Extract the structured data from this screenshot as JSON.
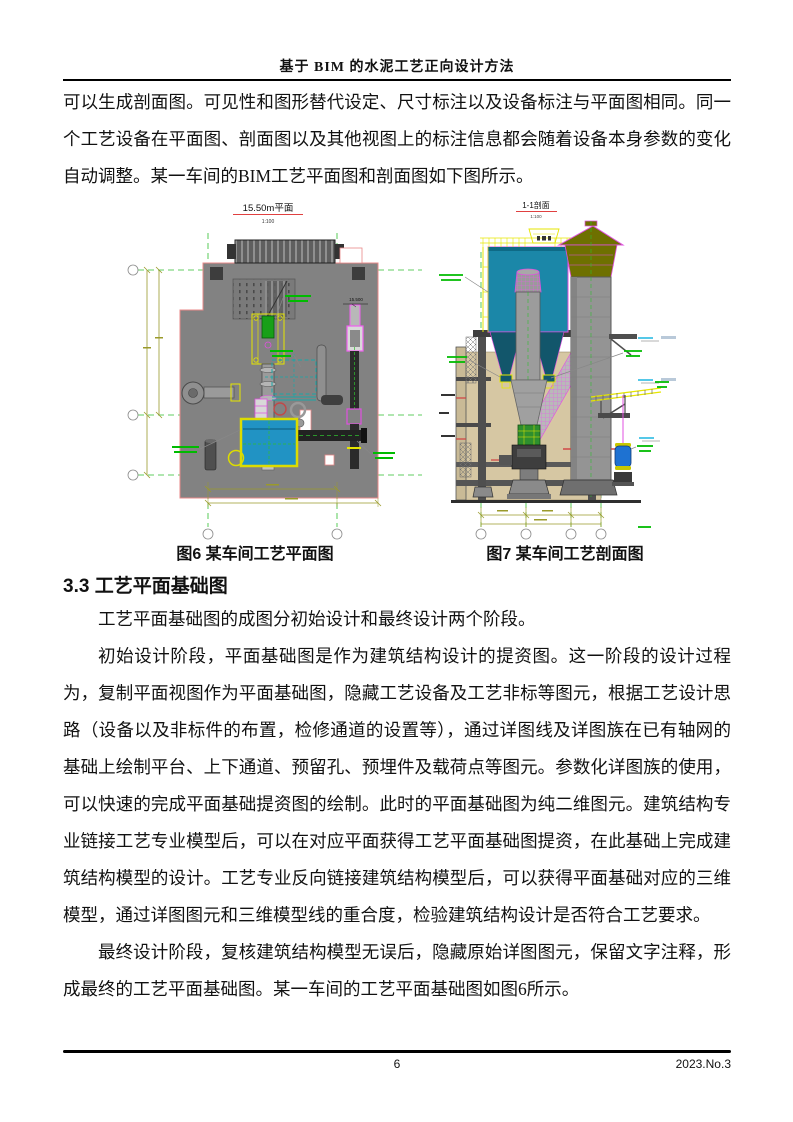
{
  "header": {
    "title": "基于 BIM 的水泥工艺正向设计方法"
  },
  "body": {
    "p1": "可以生成剖面图。可见性和图形替代设定、尺寸标注以及设备标注与平面图相同。同一个工艺设备在平面图、剖面图以及其他视图上的标注信息都会随着设备本身参数的变化自动调整。某一车间的BIM工艺平面图和剖面图如下图所示。",
    "p2": "工艺平面基础图的成图分初始设计和最终设计两个阶段。",
    "p3": "初始设计阶段，平面基础图是作为建筑结构设计的提资图。这一阶段的设计过程为，复制平面视图作为平面基础图，隐藏工艺设备及工艺非标等图元，根据工艺设计思路（设备以及非标件的布置，检修通道的设置等），通过详图线及详图族在已有轴网的基础上绘制平台、上下通道、预留孔、预埋件及载荷点等图元。参数化详图族的使用，可以快速的完成平面基础提资图的绘制。此时的平面基础图为纯二维图元。建筑结构专业链接工艺专业模型后，可以在对应平面获得工艺平面基础图提资，在此基础上完成建筑结构模型的设计。工艺专业反向链接建筑结构模型后，可以获得平面基础对应的三维模型，通过详图图元和三维模型线的重合度，检验建筑结构设计是否符合工艺要求。",
    "p4": "最终设计阶段，复核建筑结构模型无误后，隐藏原始详图图元，保留文字注释，形成最终的工艺平面基础图。某一车间的工艺平面基础图如图6所示。"
  },
  "section_heading": "3.3 工艺平面基础图",
  "figures": {
    "plan": {
      "title": "15.50m平面",
      "scale": "1:100",
      "elevation_label": "15.500",
      "caption": "图6 某车间工艺平面图"
    },
    "section": {
      "title": "1-1剖面",
      "scale": "1:100",
      "caption": "图7 某车间工艺剖面图"
    }
  },
  "footer": {
    "page_number": "6",
    "issue": "2023.No.3"
  },
  "colors": {
    "grid_green": "#2FBF2F",
    "cad_magenta": "#E050E0",
    "cad_yellow": "#E6E600",
    "dim_olive": "#9a9a2a",
    "filter_teal": "#1B87A8",
    "plan_equip_blue": "#2193C4",
    "chimney_olive": "#6E7000",
    "floor_gray": "#828282",
    "wall_tan": "#D6C7A3",
    "title_underline_red": "#E04040"
  }
}
